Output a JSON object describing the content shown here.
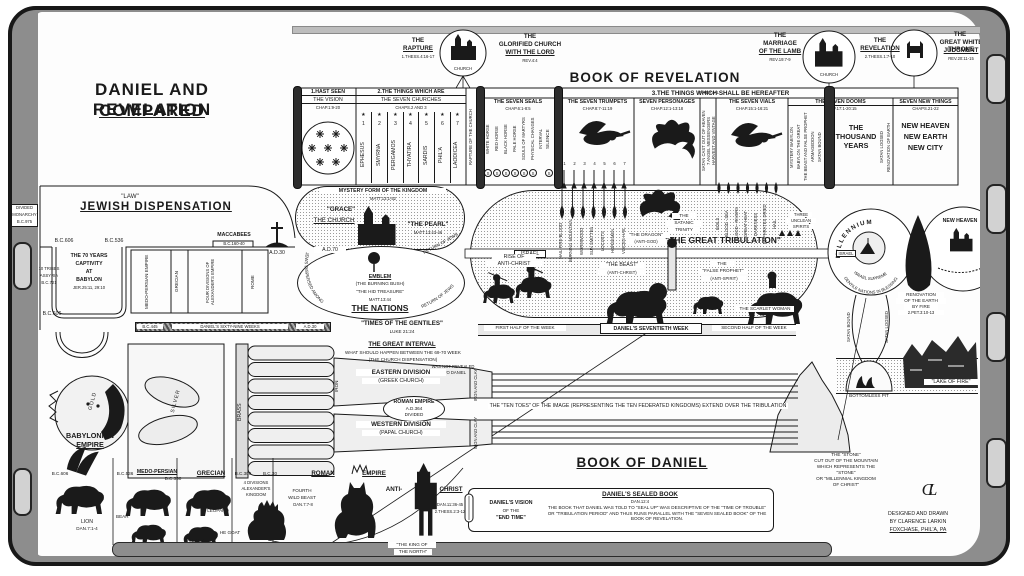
{
  "colors": {
    "ink": "#1a1a1a",
    "paper": "#ffffff",
    "edge_gray": "#8d8d8d"
  },
  "title": {
    "l1": "DANIEL AND REVELATION",
    "l2": "COMPARED"
  },
  "vignettes": {
    "rapture": {
      "t1": "THE",
      "t2": "RAPTURE",
      "ref": "1.THESS.4:16-17",
      "circle": "CHURCH"
    },
    "glorified": {
      "t1": "THE",
      "t2": "GLORIFIED CHURCH",
      "t3": "WITH THE LORD",
      "ref": "REV.4:4"
    },
    "marriage": {
      "t1": "THE",
      "t2": "MARRIAGE",
      "t3": "OF THE LAMB",
      "ref": "REV.19:7-9",
      "circle": "CHURCH"
    },
    "revelation": {
      "t1": "THE",
      "t2": "REVELATION",
      "ref": "2.THESS.1:7-10"
    },
    "throne": {
      "t1": "THE",
      "t2": "GREAT WHITE THRONE",
      "t3": "JUDGMENT",
      "ref": "REV.20:11-15"
    }
  },
  "rev": {
    "book": "BOOK OF REVELATION",
    "hereafter": "3.THE THINGS WHICH SHALL BE HEREAFTER",
    "vision": {
      "h": "1.HAST SEEN",
      "s": "THE VISION",
      "c": "CHAP.1:9-20"
    },
    "churches": {
      "h": "2.THE THINGS WHICH ARE",
      "s": "THE SEVEN CHURCHES",
      "c": "CHAPS.2 AND 3",
      "star": "★",
      "names": [
        "EPHESUS",
        "SMYRNA",
        "PERGAMOS",
        "THYATIRA",
        "SARDIS",
        "PHIL'A",
        "LAODICEA"
      ],
      "nums": [
        "1",
        "2",
        "3",
        "4",
        "5",
        "6",
        "7"
      ]
    },
    "rapture_strip": "RAPTURE OF THE CHURCH",
    "seals": {
      "h": "THE SEVEN SEALS",
      "c": "CHAP.6:1-8:5",
      "mark": "S",
      "items": [
        "WHITE HORSE",
        "RED HORSE",
        "BLACK HORSE",
        "PALE HORSE",
        "SOULS OF MARTYRS",
        "PHYSICAL CHANGES",
        "INTERVAL",
        "SILENCE"
      ]
    },
    "trumpets": {
      "h": "THE SEVEN TRUMPETS",
      "c": "CHAP.8:7-11:19",
      "nums": [
        "1",
        "2",
        "3",
        "4",
        "5",
        "6",
        "7"
      ]
    },
    "personages": {
      "h": "SEVEN PERSONAGES",
      "c": "CHAP.12:1-13:18"
    },
    "interval": {
      "h": "INTERVAL",
      "strips": [
        "SATAN CAST OUT OF HEAVEN",
        "7 ANGEL MESSENGERS",
        "HARVEST AND VINTAGE"
      ]
    },
    "vials": {
      "h": "THE SEVEN VIALS",
      "c": "CHAP.15:1-16:21"
    },
    "dooms": {
      "h": "THE SEVEN DOOMS",
      "c": "CHAP.17:1-20:15",
      "strips": [
        "MYSTERY BABYLON",
        "BABYLON THE GREAT",
        "THE BEAST AND FALSE PROPHET",
        "ARMAGEDDON",
        "SATAN BOUND"
      ],
      "main1": "THE",
      "main2": "THOUSAND",
      "main3": "YEARS",
      "right": [
        "SATAN LOOSED",
        "RENOVATION OF EARTH"
      ]
    },
    "newthings": {
      "h": "SEVEN NEW THINGS",
      "c": "CHAPS.21-22",
      "lines": [
        "NEW HEAVEN",
        "NEW EARTH",
        "NEW CITY"
      ]
    }
  },
  "jewish": {
    "law": "\"LAW\"",
    "title": "JEWISH DISPENSATION",
    "bc606": "B.C.606",
    "bc536": "B.C.536",
    "maccabees": "MACCABEES",
    "mac_date": "B.C.160-40",
    "ad30": "A.D.30",
    "cap1": "THE 70 YEARS",
    "cap2": "CAPTIVITY",
    "cap3": "AT",
    "cap4": "BABYLON",
    "cap_ref": "JER.25:11, 29:10",
    "tribes1": "10 TRIBES",
    "tribes2": "ASSYRIA",
    "tribes3": "B.C.721",
    "bc606b": "B.C.606",
    "empires": [
      "MEDO-PERSIAN EMPIRE",
      "GRECIAN",
      "FOUR DIVISIONS OF ALEXANDER'S EMPIRE",
      "ROME"
    ],
    "edge1": "DIVIDED",
    "edge2": "MONARCHY",
    "edge3": "B.C.975"
  },
  "mystery": {
    "h": "MYSTERY FORM OF THE KINGDOM",
    "ref": "MATT.13:1-52",
    "grace": "\"GRACE\"",
    "church": "THE CHURCH",
    "pearl": "\"THE PEARL\"",
    "pearl_ref": "MATT.13:43-46",
    "ad70": "A.D.70",
    "emblem": "EMBLEM",
    "bush": "(THE BURNING BUSH)",
    "treasure": "\"THE HID TREASURE\"",
    "tref": "MATT.13:44",
    "nations": "THE NATIONS",
    "dispersed": "JEWS DISPERSED AMONG",
    "return1": "RETURN OF JEWS",
    "return2": "RETURN OF JEWS"
  },
  "weeks": {
    "bc445": "B.C.445",
    "sixty_nine": "DANIEL'S SIXTY-NINE WEEKS",
    "ad30": "A.D.30",
    "gentiles": "\"TIMES OF THE GENTILES\"",
    "gentiles_ref": "LUKE 21:24",
    "first": "FIRST HALF OF THE WEEK",
    "seventieth": "DANIEL'S SEVENTIETH WEEK",
    "second": "SECOND HALF OF THE WEEK"
  },
  "trib": {
    "title": "\"THE GREAT TRIBULATION\"",
    "israel": "ISRAEL",
    "israel2": "ISRAEL",
    "rise1": "RISE OF",
    "rise2": "ANTI-CHRIST",
    "trin1": "THE",
    "trin2": "SATANIC",
    "trin3": "TRINITY",
    "dragon": "\"THE DRAGON\"",
    "dragon2": "(ANTI-GOD)",
    "beast": "\"THE BEAST\"",
    "beast2": "(ANTI-CHRIST)",
    "fp1": "THE",
    "fp2": "\"FALSE PROPHET\"",
    "fp3": "(ANTI-SPIRIT)",
    "scarlet": "THE SCARLET WOMAN",
    "un1": "THREE",
    "un2": "UNCLEAN",
    "un3": "SPIRITS",
    "tdrops": [
      "HAIL-FIRE-BLOOD",
      "BURNING MOUNTAIN",
      "WORMWOOD",
      "SUN SMITTEN",
      "LOCUSTS",
      "HORSEMEN",
      "VOICES-HAIL"
    ],
    "vdrops": [
      "BOILS",
      "BLOOD - SEA",
      "BLOOD - RIVERS",
      "GREAT HEAT",
      "DARKNESS",
      "EUPHRATES DRIED",
      "HAIL"
    ]
  },
  "mill": {
    "title": "MILLENNIUM",
    "arc1": "ISRAEL SUPREME",
    "arc2": "GENTILE NATIONS IN BLESSING"
  },
  "renov": {
    "l1": "RENOVATION",
    "l2": "OF THE EARTH",
    "l3": "BY FIRE",
    "ref": "2.PET.3:10-13"
  },
  "heaven": {
    "title": "NEW HEAVEN"
  },
  "satan": {
    "bound": "SATAN BOUND",
    "loosed": "SATAN LOOSED"
  },
  "pit": "BOTTOMLESS PIT",
  "lake": "\"LAKE OF FIRE\"",
  "interval_block": {
    "h": "THE GREAT INTERVAL",
    "l1": "WHAT SHOULD HAPPEN BETWEEN THE 69-70 WEEK",
    "l2": "(THE CHURCH DISPENSATION)",
    "l3": "WAS NOT REVEALED",
    "l4": "TO DANIEL"
  },
  "image": {
    "gold": "GOLD",
    "silver": "SILVER",
    "brass": "BRASS",
    "iron": "IRON",
    "ironclay": "IRON AND CLAY",
    "roman1": "ROMAN EMPIRE",
    "roman2": "A.D.364",
    "roman3": "DIVIDED",
    "east1": "EASTERN DIVISION",
    "east2": "(GREEK CHURCH)",
    "west1": "WESTERN DIVISION",
    "west2": "(PAPAL CHURCH)",
    "toes": "THE \"TEN TOES\" OF THE IMAGE (REPRESENTING THE TEN FEDERATED KINGDOMS) EXTEND OVER THE TRIBULATION"
  },
  "daniel": {
    "book": "BOOK OF DANIEL",
    "babylon": {
      "t1": "BABYLONIAN",
      "t2": "EMPIRE",
      "date": "B.C.606",
      "animal": "LION",
      "ref": "DAN.7:1-4"
    },
    "medo": {
      "d1": "B.C.536",
      "t": "MEDO-PERSIAN",
      "d2": "B.C.330",
      "bear": "BEAR",
      "ram": "RAM",
      "ref": "DAN.8:1-7"
    },
    "grecian": {
      "t": "GRECIAN",
      "d1": "B.C.309",
      "div1": "4 DIVISIONS",
      "div2": "ALEXANDER'S",
      "div3": "KINGDOM",
      "d2": "B.C.30",
      "leopard": "LEOPARD",
      "goat": "HE GOAT"
    },
    "roman": {
      "t1": "ROMAN",
      "t2": "EMPIRE",
      "b1": "FOURTH",
      "b2": "WILD BEAST",
      "ref": "DAN.7:7-8"
    },
    "anti": {
      "t1": "ANTI-",
      "t2": "CHRIST",
      "ref1": "DAN.11:36-45",
      "ref2": "2.THESS.2:3-12",
      "king1": "\"THE KING OF",
      "king2": "THE NORTH\""
    },
    "vision": {
      "l1": "DANIEL'S VISION",
      "l2": "OF THE",
      "l3": "\"END TIME\""
    },
    "sealed": {
      "h": "DANIEL'S SEALED BOOK",
      "ref": "DAN.12:4",
      "body": "THE BOOK THAT DANIEL WAS TOLD TO \"SEAL UP\" WAS DESCRIPTIVE OF THE \"TIME OF TROUBLE\" OR \"TRIBULATION PERIOD\" AND THUS RUNS PARALLEL WITH THE \"SEVEN SEALED BOOK\" OF THE BOOK OF REVELATION."
    }
  },
  "stone": {
    "l1": "THE \"STONE\"",
    "l2": "CUT OUT OF THE MOUNTAIN",
    "l3": "WHICH REPRESENTS THE",
    "l4": "\"STONE\"",
    "l5": "OR \"MILLENNIAL KINGDOM",
    "l6": "OF CHRIST\""
  },
  "signature": {
    "monogram": "CL",
    "l1": "DESIGNED AND DRAWN",
    "l2": "BY CLARENCE LARKIN",
    "l3": "FOXCHASE, PHIL'A, PA"
  },
  "icons": {
    "church-icon": "black church silhouette",
    "angel-icon": "winged messenger",
    "dragon-icon": "winged dragon",
    "beast-icon": "quadruped beast",
    "lamb-icon": "lamb",
    "horse-rider-icon": "mounted horseman",
    "winged-lion-icon": "lion with eagle wings",
    "bear-icon": "bear",
    "ram-icon": "ram",
    "leopard-icon": "leopard",
    "he-goat-icon": "goat",
    "four-headed-beast-icon": "four-headed leopard",
    "fourth-beast-icon": "crowned wild beast",
    "antichrist-statue-icon": "crowned standing figure",
    "throne-icon": "great white throne",
    "lampstands-icon": "seven candlesticks emblem",
    "burning-bush-icon": "bush aflame",
    "flame-icon": "fire teardrop",
    "trumpet-icon": "descending trumpet",
    "vial-icon": "poured vial drop",
    "seal-icon": "circled S",
    "scroll-icon": "rolled scroll",
    "monogram-icon": "CL monogram",
    "scarlet-woman-icon": "woman on beast",
    "unclean-spirits-icon": "three frog spirits",
    "tower-icon": "watch tower",
    "stone-mountain-icon": "stone mountain",
    "lake-of-fire-icon": "burning rocks",
    "bottomless-pit-icon": "pit dome",
    "roller-icon": "chart roller knob",
    "colossus-icon": "reclining metal image",
    "cross-icon": "cross on hill"
  }
}
